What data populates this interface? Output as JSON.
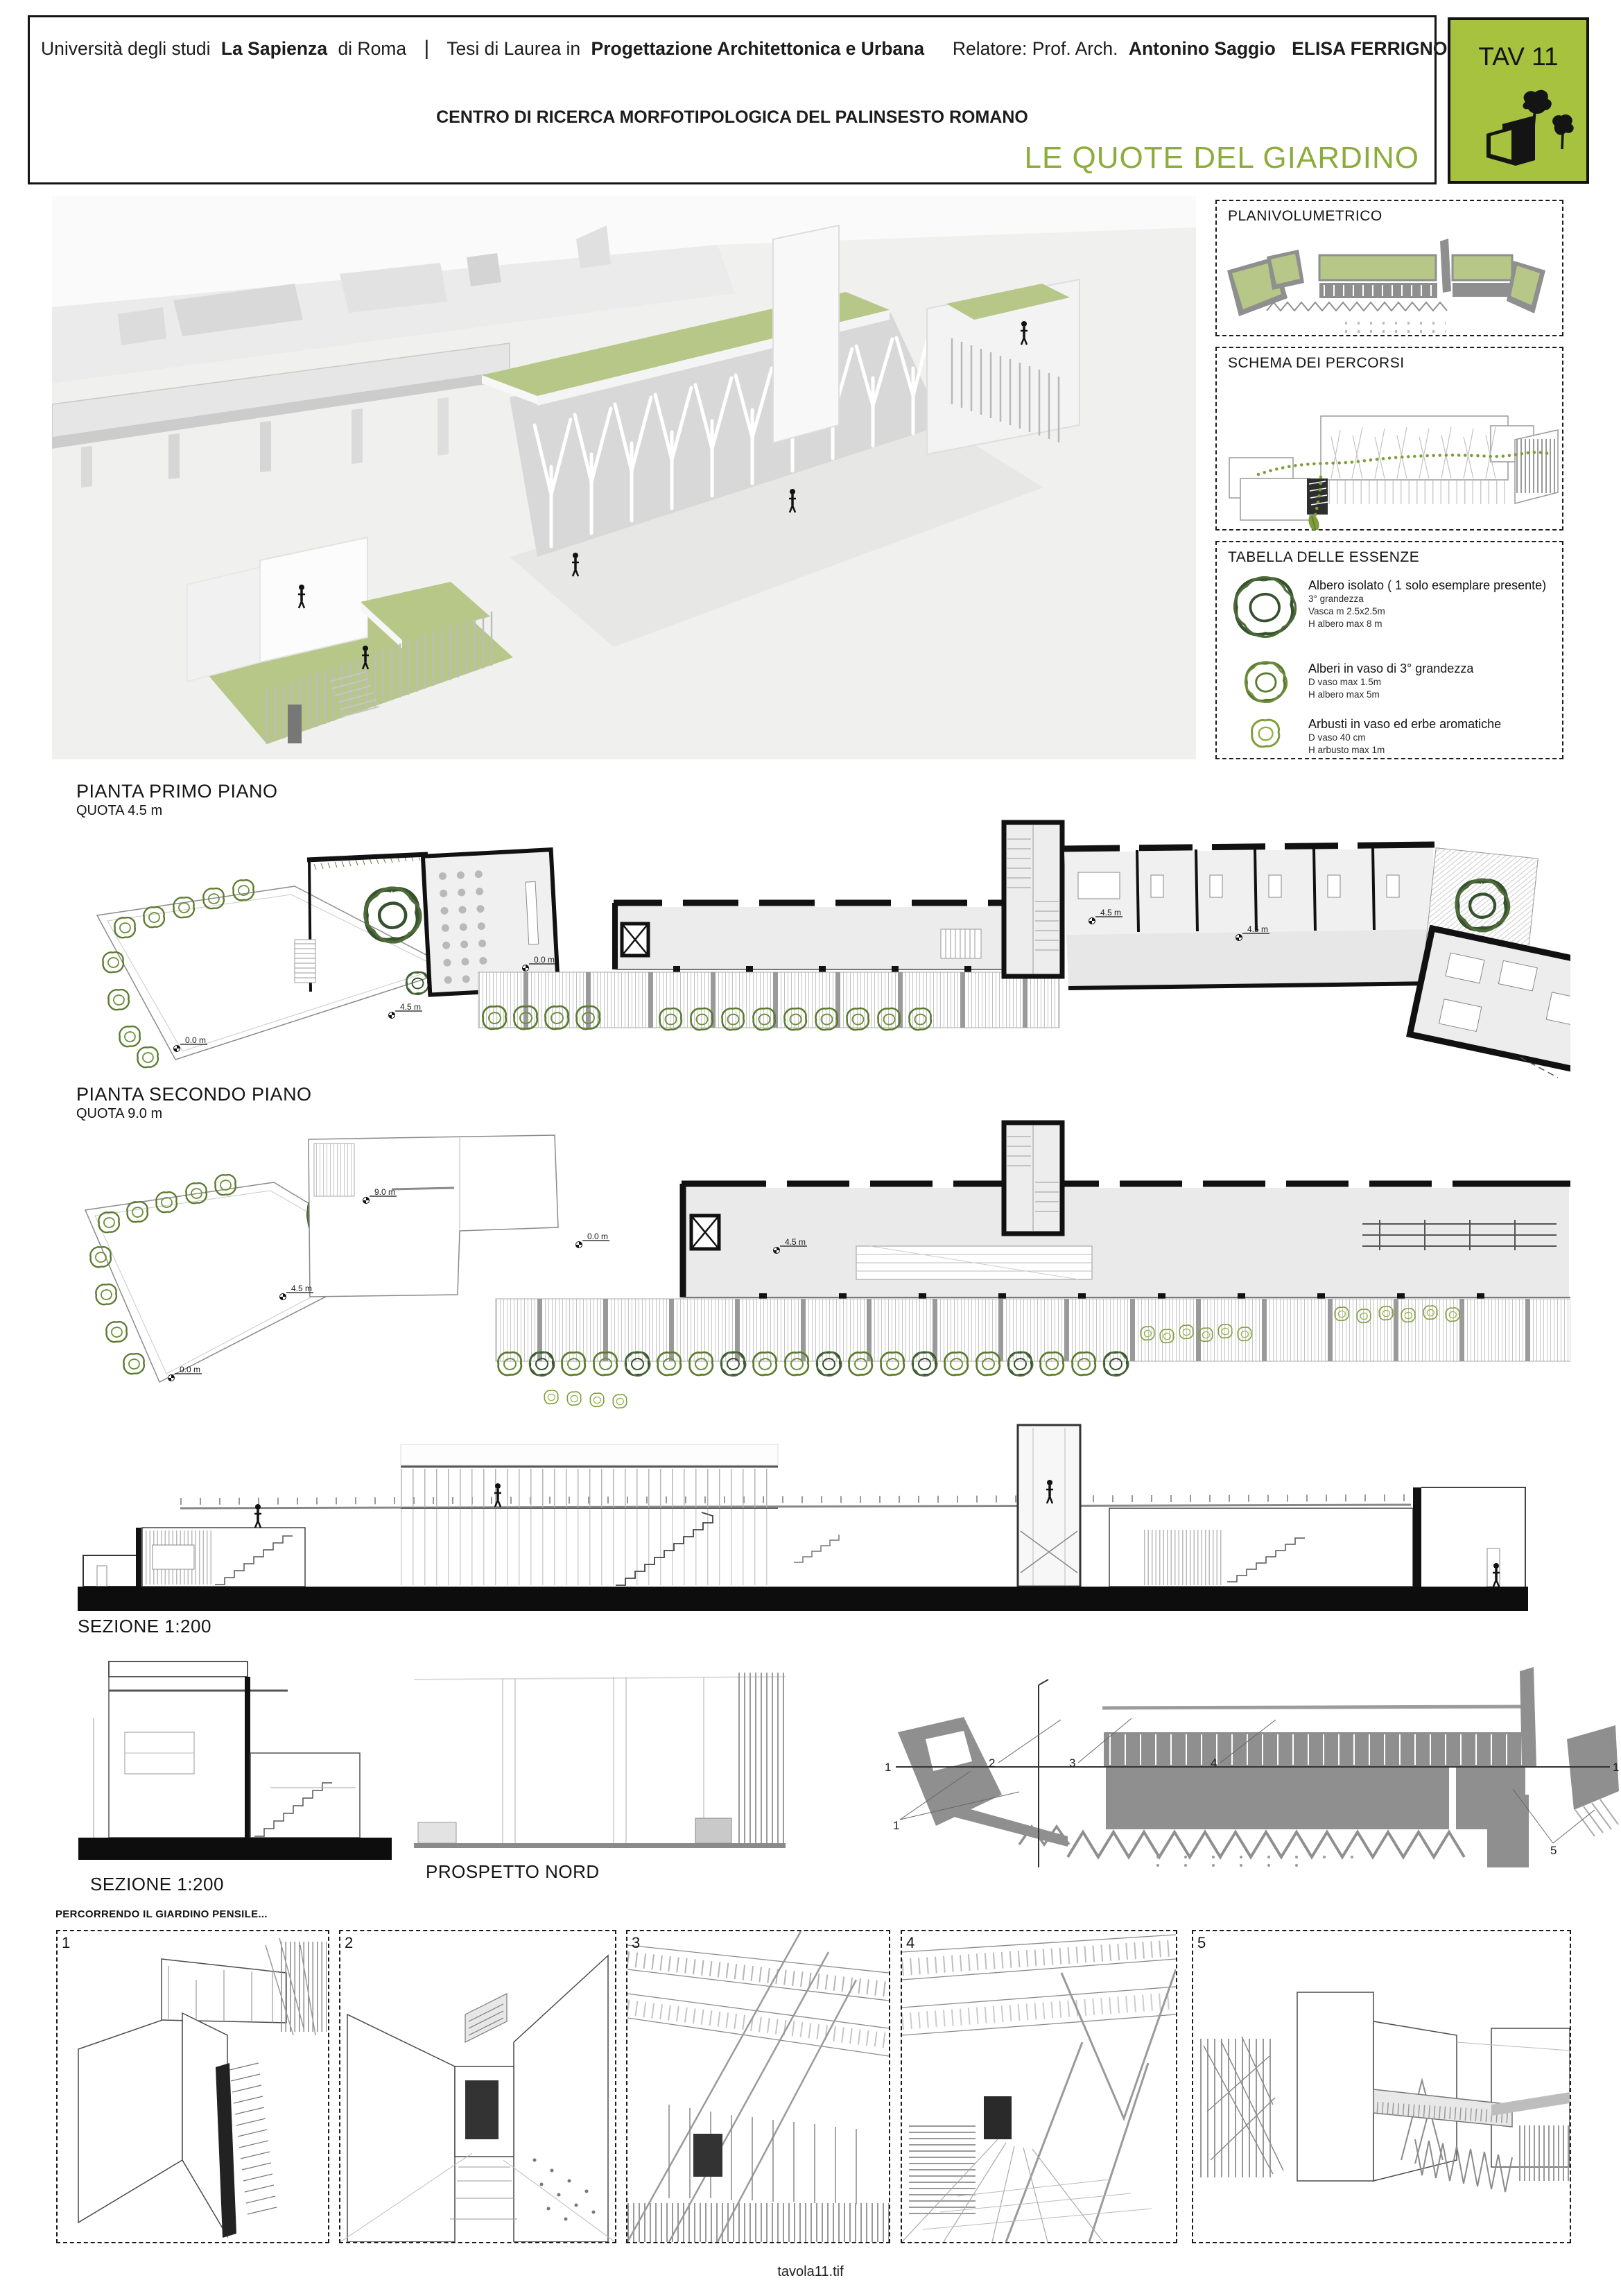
{
  "header": {
    "line1": {
      "t1": "Università degli studi",
      "b1": "La Sapienza",
      "t2": "di Roma",
      "sep": "|",
      "t3": "Tesi di Laurea in",
      "b2": "Progettazione Architettonica e Urbana",
      "t4": "Relatore:  Prof. Arch.",
      "b3": "Antonino Saggio",
      "b4": "ELISA FERRIGNO"
    },
    "subtitle": "CENTRO DI RICERCA MORFOTIPOLOGICA DEL PALINSESTO ROMANO",
    "title": "LE QUOTE DEL GIARDINO",
    "tav_label": "TAV 11"
  },
  "colors": {
    "accent_green": "#8cac3b",
    "tav_green": "#a6c23f",
    "roof_green": "#b6c787"
  },
  "sidebar": {
    "planivolumetrico_title": "PLANIVOLUMETRICO",
    "schema_title": "SCHEMA DEI PERCORSI",
    "tabella": {
      "title": "TABELLA DELLE ESSENZE",
      "items": [
        {
          "name": "Albero isolato ( 1 solo esemplare presente)",
          "lines": [
            "3° grandezza",
            "Vasca m 2.5x2.5m",
            "H albero max 8 m"
          ]
        },
        {
          "name": "Alberi in vaso di 3° grandezza",
          "lines": [
            "D vaso max 1.5m",
            "H albero max 5m"
          ]
        },
        {
          "name": "Arbusti in vaso ed erbe aromatiche",
          "lines": [
            "D vaso 40 cm",
            "H arbusto max 1m"
          ]
        }
      ]
    }
  },
  "plans": {
    "first": {
      "title": "PIANTA PRIMO PIANO",
      "quota": "QUOTA 4.5 m",
      "markers": [
        "0.0 m",
        "4.5 m",
        "0.0 m",
        "4.5 m",
        "4.5 m"
      ]
    },
    "second": {
      "title": "PIANTA SECONDO PIANO",
      "quota": "QUOTA 9.0 m",
      "markers": [
        "9.0 m",
        "4.5 m",
        "0.0 m",
        "0.0 m",
        "4.5 m"
      ]
    }
  },
  "sections": {
    "long_label": "SEZIONE 1:200",
    "small_label": "SEZIONE 1:200",
    "prospetto_label": "PROSPETTO NORD"
  },
  "axon": {
    "cut_left": "1",
    "cut_right": "1",
    "labels": [
      "1",
      "2",
      "3",
      "4",
      "5"
    ]
  },
  "strip": {
    "caption": "PERCORRENDO IL GIARDINO PENSILE...",
    "panels": [
      "1",
      "2",
      "3",
      "4",
      "5"
    ]
  },
  "footer": "tavola11.tif"
}
